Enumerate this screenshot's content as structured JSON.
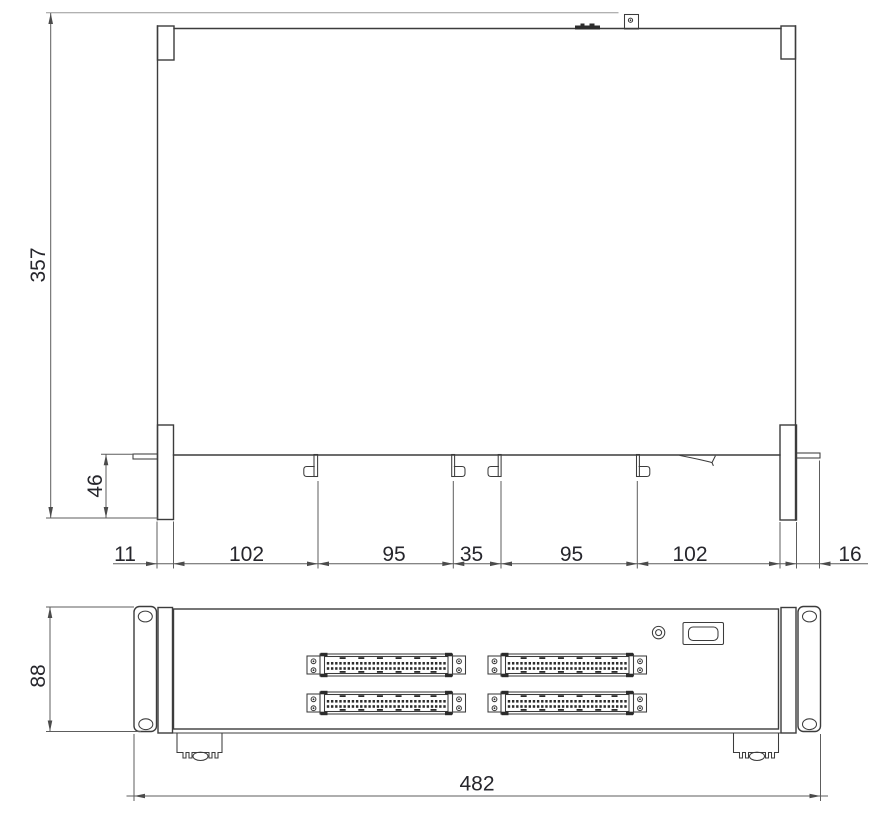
{
  "colors": {
    "ink": "#3c3c3c",
    "dim_line": "#5d5d5d",
    "label_text": "#26262c",
    "background": "#ffffff"
  },
  "top_view": {
    "depth_mm": "357",
    "front_recess_mm": "46",
    "width_chain_mm": [
      "11",
      "102",
      "95",
      "35",
      "95",
      "102",
      "16"
    ]
  },
  "front_view": {
    "height_mm": "88",
    "width_mm": "482",
    "connectors": {
      "count": 4,
      "rows_per_connector": 2,
      "pins_per_row": 29
    }
  }
}
